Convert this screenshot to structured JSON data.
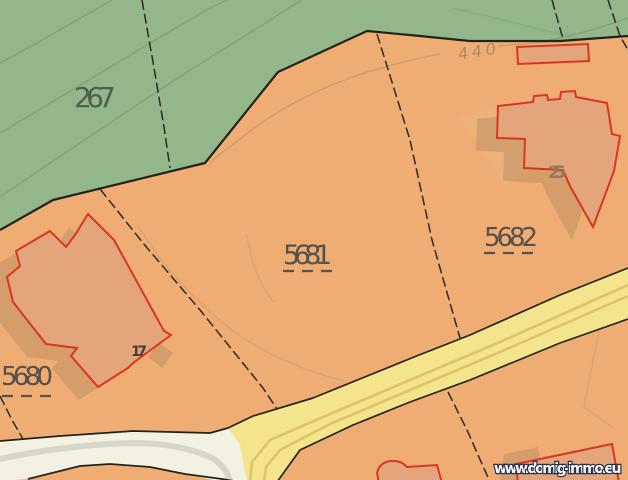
{
  "map": {
    "region_labels": {
      "forest": "267",
      "parcel_5680": "5680",
      "parcel_5681": "5681",
      "parcel_5682": "5682"
    },
    "building_labels": {
      "house_25": "25",
      "house_17": "17"
    },
    "contour_elevation": "440",
    "watermark": "www.domig-immo.eu",
    "colors": {
      "parcel_orange": "#efad73",
      "forest_green": "#93b68b",
      "road_yellow": "#f4e58d",
      "road_lane": "#dcc46a",
      "path_white": "#f2f1e2",
      "path_band": "#d8d6c6",
      "building_fill": "#e5a57c",
      "building_red": "#d6391f",
      "boundary_black": "#23231b",
      "parcel_line": "#2a2a20",
      "contour_green": "#7da173",
      "contour_brown": "#c5976b",
      "shadow_brown": "#8a6f52",
      "label_gray": "#56524b",
      "label_green": "#4f5f4a",
      "label_brown": "#97795a",
      "elevation_brown": "#a98a63",
      "watermark_white": "#ffffff",
      "watermark_outline": "#27304a"
    }
  }
}
